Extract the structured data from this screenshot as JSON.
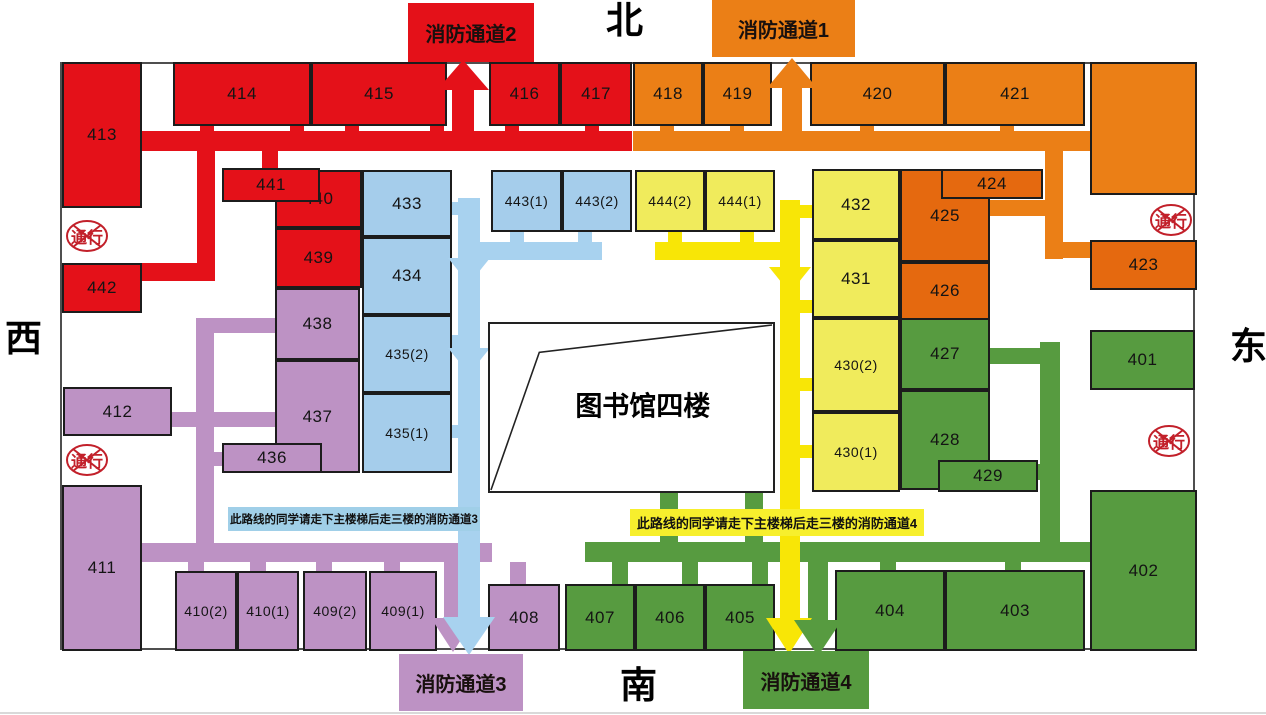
{
  "compass": {
    "north": "北",
    "south": "南",
    "west": "西",
    "east": "东"
  },
  "center": {
    "label": "图书馆四楼",
    "x": 488,
    "y": 322,
    "w": 287,
    "h": 171
  },
  "no_entry": {
    "label": "通行",
    "positions": [
      [
        64,
        218
      ],
      [
        64,
        442
      ],
      [
        1148,
        202
      ],
      [
        1146,
        423
      ]
    ]
  },
  "exits": {
    "fire1": {
      "label": "消防通道1",
      "x": 712,
      "y": 0,
      "w": 143,
      "h": 57,
      "fill": "orange_light"
    },
    "fire2": {
      "label": "消防通道2",
      "x": 408,
      "y": 3,
      "w": 126,
      "h": 59,
      "fill": "red"
    },
    "fire3": {
      "label": "消防通道3",
      "x": 399,
      "y": 654,
      "w": 124,
      "h": 57,
      "fill": "purple"
    },
    "fire4": {
      "label": "消防通道4",
      "x": 743,
      "y": 651,
      "w": 126,
      "h": 58,
      "fill": "green"
    }
  },
  "banners": {
    "route3": {
      "text": "此路线的同学请走下主楼梯后走三楼的消防通道3",
      "x": 228,
      "y": 507,
      "w": 252,
      "h": 24,
      "fill": "banner_blue_bg"
    },
    "route4": {
      "text": "此路线的同学请走下主楼梯后走三楼的消防通道4",
      "x": 630,
      "y": 509,
      "w": 294,
      "h": 27,
      "fill": "banner_yellow_bg"
    }
  },
  "colors": {
    "red": "#e41119",
    "orange_light": "#eb7f16",
    "orange_deep": "#e5690f",
    "blue_room": "#a5cdeb",
    "blue_path": "#a8d2ef",
    "yellow_room": "#f0eb5c",
    "yellow_path": "#f8e606",
    "purple": "#bd92c4",
    "green": "#579b40",
    "banner_blue_bg": "#a0cfe8",
    "banner_yellow_bg": "#f7ef2d",
    "sign_red": "#c2202a",
    "wall": "#4f4f4f"
  },
  "rooms": [
    {
      "label": "413",
      "c": "red",
      "x": 62,
      "y": 62,
      "w": 80,
      "h": 146
    },
    {
      "label": "414",
      "c": "red",
      "x": 173,
      "y": 62,
      "w": 138,
      "h": 64
    },
    {
      "label": "415",
      "c": "red",
      "x": 311,
      "y": 62,
      "w": 136,
      "h": 64
    },
    {
      "label": "416",
      "c": "red",
      "x": 489,
      "y": 62,
      "w": 71,
      "h": 64
    },
    {
      "label": "417",
      "c": "red",
      "x": 560,
      "y": 62,
      "w": 72,
      "h": 64
    },
    {
      "label": "440",
      "c": "red",
      "x": 275,
      "y": 170,
      "w": 87,
      "h": 58
    },
    {
      "label": "441",
      "c": "red",
      "x": 222,
      "y": 168,
      "w": 98,
      "h": 34
    },
    {
      "label": "439",
      "c": "red",
      "x": 275,
      "y": 228,
      "w": 87,
      "h": 60
    },
    {
      "label": "442",
      "c": "red",
      "x": 62,
      "y": 263,
      "w": 80,
      "h": 50
    },
    {
      "label": "418",
      "c": "orange_light",
      "x": 633,
      "y": 62,
      "w": 70,
      "h": 64
    },
    {
      "label": "419",
      "c": "orange_light",
      "x": 703,
      "y": 62,
      "w": 69,
      "h": 64
    },
    {
      "label": "420",
      "c": "orange_light",
      "x": 810,
      "y": 62,
      "w": 135,
      "h": 64
    },
    {
      "label": "421",
      "c": "orange_light",
      "x": 945,
      "y": 62,
      "w": 140,
      "h": 64
    },
    {
      "label": "",
      "c": "orange_light",
      "x": 1090,
      "y": 62,
      "w": 107,
      "h": 133
    },
    {
      "label": "425",
      "c": "orange_deep",
      "x": 900,
      "y": 169,
      "w": 90,
      "h": 93
    },
    {
      "label": "424",
      "c": "orange_deep",
      "x": 941,
      "y": 169,
      "w": 102,
      "h": 30
    },
    {
      "label": "426",
      "c": "orange_deep",
      "x": 900,
      "y": 262,
      "w": 90,
      "h": 58
    },
    {
      "label": "423",
      "c": "orange_deep",
      "x": 1090,
      "y": 240,
      "w": 107,
      "h": 50
    },
    {
      "label": "433",
      "c": "blue_room",
      "x": 362,
      "y": 170,
      "w": 90,
      "h": 67
    },
    {
      "label": "434",
      "c": "blue_room",
      "x": 362,
      "y": 237,
      "w": 90,
      "h": 78
    },
    {
      "label": "435(2)",
      "c": "blue_room",
      "x": 362,
      "y": 315,
      "w": 90,
      "h": 78
    },
    {
      "label": "435(1)",
      "c": "blue_room",
      "x": 362,
      "y": 393,
      "w": 90,
      "h": 80
    },
    {
      "label": "443(1)",
      "c": "blue_room",
      "x": 491,
      "y": 170,
      "w": 71,
      "h": 62
    },
    {
      "label": "443(2)",
      "c": "blue_room",
      "x": 562,
      "y": 170,
      "w": 70,
      "h": 62
    },
    {
      "label": "444(2)",
      "c": "yellow_room",
      "x": 635,
      "y": 170,
      "w": 70,
      "h": 62
    },
    {
      "label": "444(1)",
      "c": "yellow_room",
      "x": 705,
      "y": 170,
      "w": 70,
      "h": 62
    },
    {
      "label": "432",
      "c": "yellow_room",
      "x": 812,
      "y": 169,
      "w": 88,
      "h": 71
    },
    {
      "label": "431",
      "c": "yellow_room",
      "x": 812,
      "y": 240,
      "w": 88,
      "h": 78
    },
    {
      "label": "430(2)",
      "c": "yellow_room",
      "x": 812,
      "y": 318,
      "w": 88,
      "h": 94
    },
    {
      "label": "430(1)",
      "c": "yellow_room",
      "x": 812,
      "y": 412,
      "w": 88,
      "h": 80
    },
    {
      "label": "438",
      "c": "purple",
      "x": 275,
      "y": 288,
      "w": 85,
      "h": 72
    },
    {
      "label": "437",
      "c": "purple",
      "x": 275,
      "y": 360,
      "w": 85,
      "h": 113
    },
    {
      "label": "436",
      "c": "purple",
      "x": 222,
      "y": 443,
      "w": 100,
      "h": 30
    },
    {
      "label": "412",
      "c": "purple",
      "x": 63,
      "y": 387,
      "w": 109,
      "h": 49
    },
    {
      "label": "411",
      "c": "purple",
      "x": 62,
      "y": 485,
      "w": 80,
      "h": 166
    },
    {
      "label": "410(2)",
      "c": "purple",
      "x": 175,
      "y": 571,
      "w": 62,
      "h": 80
    },
    {
      "label": "410(1)",
      "c": "purple",
      "x": 237,
      "y": 571,
      "w": 62,
      "h": 80
    },
    {
      "label": "409(2)",
      "c": "purple",
      "x": 303,
      "y": 571,
      "w": 64,
      "h": 80
    },
    {
      "label": "409(1)",
      "c": "purple",
      "x": 369,
      "y": 571,
      "w": 68,
      "h": 80
    },
    {
      "label": "408",
      "c": "purple",
      "x": 488,
      "y": 584,
      "w": 72,
      "h": 67
    },
    {
      "label": "427",
      "c": "green",
      "x": 900,
      "y": 318,
      "w": 90,
      "h": 72
    },
    {
      "label": "428",
      "c": "green",
      "x": 900,
      "y": 390,
      "w": 90,
      "h": 100
    },
    {
      "label": "429",
      "c": "green",
      "x": 938,
      "y": 460,
      "w": 100,
      "h": 32
    },
    {
      "label": "401",
      "c": "green",
      "x": 1090,
      "y": 330,
      "w": 105,
      "h": 60
    },
    {
      "label": "402",
      "c": "green",
      "x": 1090,
      "y": 490,
      "w": 107,
      "h": 161
    },
    {
      "label": "404",
      "c": "green",
      "x": 835,
      "y": 570,
      "w": 110,
      "h": 81
    },
    {
      "label": "403",
      "c": "green",
      "x": 945,
      "y": 570,
      "w": 140,
      "h": 81
    },
    {
      "label": "407",
      "c": "green",
      "x": 565,
      "y": 584,
      "w": 70,
      "h": 67
    },
    {
      "label": "406",
      "c": "green",
      "x": 635,
      "y": 584,
      "w": 70,
      "h": 67
    },
    {
      "label": "405",
      "c": "green",
      "x": 705,
      "y": 584,
      "w": 70,
      "h": 67
    }
  ],
  "corridors": [
    {
      "c": "purple",
      "x": 196,
      "y": 318,
      "w": 18,
      "h": 225
    },
    {
      "c": "purple",
      "x": 196,
      "y": 318,
      "w": 79,
      "h": 15
    },
    {
      "c": "purple",
      "x": 172,
      "y": 412,
      "w": 103,
      "h": 15
    },
    {
      "c": "purple",
      "x": 214,
      "y": 452,
      "w": 10,
      "h": 14
    },
    {
      "c": "purple",
      "x": 142,
      "y": 543,
      "w": 350,
      "h": 19
    },
    {
      "c": "purple",
      "x": 188,
      "y": 562,
      "w": 16,
      "h": 9
    },
    {
      "c": "purple",
      "x": 250,
      "y": 562,
      "w": 16,
      "h": 9
    },
    {
      "c": "purple",
      "x": 316,
      "y": 562,
      "w": 16,
      "h": 9
    },
    {
      "c": "purple",
      "x": 384,
      "y": 562,
      "w": 16,
      "h": 9
    },
    {
      "c": "purple",
      "x": 510,
      "y": 562,
      "w": 16,
      "h": 22
    },
    {
      "c": "purple",
      "x": 444,
      "y": 562,
      "w": 18,
      "h": 58
    },
    {
      "c": "green",
      "x": 585,
      "y": 542,
      "w": 507,
      "h": 20
    },
    {
      "c": "green",
      "x": 660,
      "y": 492,
      "w": 18,
      "h": 52
    },
    {
      "c": "green",
      "x": 745,
      "y": 492,
      "w": 18,
      "h": 52
    },
    {
      "c": "green",
      "x": 1040,
      "y": 342,
      "w": 20,
      "h": 202
    },
    {
      "c": "green",
      "x": 990,
      "y": 348,
      "w": 52,
      "h": 16
    },
    {
      "c": "green",
      "x": 1028,
      "y": 464,
      "w": 16,
      "h": 16
    },
    {
      "c": "green",
      "x": 612,
      "y": 562,
      "w": 16,
      "h": 22
    },
    {
      "c": "green",
      "x": 682,
      "y": 562,
      "w": 16,
      "h": 22
    },
    {
      "c": "green",
      "x": 752,
      "y": 562,
      "w": 16,
      "h": 22
    },
    {
      "c": "green",
      "x": 880,
      "y": 562,
      "w": 16,
      "h": 8
    },
    {
      "c": "green",
      "x": 1005,
      "y": 562,
      "w": 16,
      "h": 8
    },
    {
      "c": "green",
      "x": 808,
      "y": 562,
      "w": 20,
      "h": 64
    },
    {
      "c": "red",
      "x": 142,
      "y": 131,
      "w": 490,
      "h": 20
    },
    {
      "c": "red",
      "x": 200,
      "y": 126,
      "w": 14,
      "h": 6
    },
    {
      "c": "red",
      "x": 290,
      "y": 126,
      "w": 14,
      "h": 6
    },
    {
      "c": "red",
      "x": 345,
      "y": 126,
      "w": 14,
      "h": 6
    },
    {
      "c": "red",
      "x": 430,
      "y": 126,
      "w": 14,
      "h": 6
    },
    {
      "c": "red",
      "x": 505,
      "y": 126,
      "w": 14,
      "h": 6
    },
    {
      "c": "red",
      "x": 585,
      "y": 126,
      "w": 14,
      "h": 6
    },
    {
      "c": "red",
      "x": 452,
      "y": 86,
      "w": 22,
      "h": 46
    },
    {
      "c": "red",
      "x": 197,
      "y": 151,
      "w": 18,
      "h": 130
    },
    {
      "c": "red",
      "x": 142,
      "y": 263,
      "w": 57,
      "h": 18
    },
    {
      "c": "red",
      "x": 262,
      "y": 151,
      "w": 16,
      "h": 20
    },
    {
      "c": "orange_light",
      "x": 633,
      "y": 131,
      "w": 457,
      "h": 20
    },
    {
      "c": "orange_light",
      "x": 660,
      "y": 126,
      "w": 14,
      "h": 6
    },
    {
      "c": "orange_light",
      "x": 730,
      "y": 126,
      "w": 14,
      "h": 6
    },
    {
      "c": "orange_light",
      "x": 860,
      "y": 126,
      "w": 14,
      "h": 6
    },
    {
      "c": "orange_light",
      "x": 1000,
      "y": 126,
      "w": 14,
      "h": 6
    },
    {
      "c": "orange_light",
      "x": 782,
      "y": 84,
      "w": 20,
      "h": 48
    },
    {
      "c": "orange_light",
      "x": 1045,
      "y": 151,
      "w": 18,
      "h": 108
    },
    {
      "c": "orange_light",
      "x": 990,
      "y": 200,
      "w": 55,
      "h": 16
    },
    {
      "c": "orange_light",
      "x": 1045,
      "y": 242,
      "w": 47,
      "h": 16
    },
    {
      "c": "blue_path",
      "x": 458,
      "y": 198,
      "w": 22,
      "h": 430
    },
    {
      "c": "blue_path",
      "x": 480,
      "y": 242,
      "w": 122,
      "h": 18
    },
    {
      "c": "blue_path",
      "x": 510,
      "y": 232,
      "w": 14,
      "h": 10
    },
    {
      "c": "blue_path",
      "x": 578,
      "y": 232,
      "w": 14,
      "h": 10
    },
    {
      "c": "blue_path",
      "x": 452,
      "y": 202,
      "w": 6,
      "h": 13
    },
    {
      "c": "blue_path",
      "x": 452,
      "y": 335,
      "w": 6,
      "h": 13
    },
    {
      "c": "blue_path",
      "x": 452,
      "y": 425,
      "w": 6,
      "h": 13
    },
    {
      "c": "yellow_path",
      "x": 780,
      "y": 200,
      "w": 20,
      "h": 424
    },
    {
      "c": "yellow_path",
      "x": 655,
      "y": 242,
      "w": 125,
      "h": 18
    },
    {
      "c": "yellow_path",
      "x": 668,
      "y": 232,
      "w": 14,
      "h": 10
    },
    {
      "c": "yellow_path",
      "x": 740,
      "y": 232,
      "w": 14,
      "h": 10
    },
    {
      "c": "yellow_path",
      "x": 800,
      "y": 205,
      "w": 12,
      "h": 13
    },
    {
      "c": "yellow_path",
      "x": 800,
      "y": 300,
      "w": 12,
      "h": 13
    },
    {
      "c": "yellow_path",
      "x": 800,
      "y": 378,
      "w": 12,
      "h": 13
    },
    {
      "c": "yellow_path",
      "x": 800,
      "y": 445,
      "w": 12,
      "h": 13
    }
  ],
  "arrowheads": [
    {
      "c": "red",
      "tip": [
        463,
        60
      ],
      "dir": "up",
      "hw": 26,
      "len": 30
    },
    {
      "c": "orange_light",
      "tip": [
        792,
        58
      ],
      "dir": "up",
      "hw": 25,
      "len": 30
    },
    {
      "c": "blue_path",
      "tip": [
        469,
        284
      ],
      "dir": "down",
      "hw": 21,
      "len": 26
    },
    {
      "c": "blue_path",
      "tip": [
        469,
        374
      ],
      "dir": "down",
      "hw": 21,
      "len": 26
    },
    {
      "c": "yellow_path",
      "tip": [
        790,
        293
      ],
      "dir": "down",
      "hw": 21,
      "len": 26
    },
    {
      "c": "purple",
      "tip": [
        453,
        652
      ],
      "dir": "down",
      "hw": 22,
      "len": 34
    },
    {
      "c": "blue_path",
      "tip": [
        469,
        655
      ],
      "dir": "down",
      "hw": 26,
      "len": 38
    },
    {
      "c": "yellow_path",
      "tip": [
        789,
        654
      ],
      "dir": "down",
      "hw": 23,
      "len": 36
    },
    {
      "c": "green",
      "tip": [
        818,
        656
      ],
      "dir": "down",
      "hw": 24,
      "len": 36
    }
  ]
}
